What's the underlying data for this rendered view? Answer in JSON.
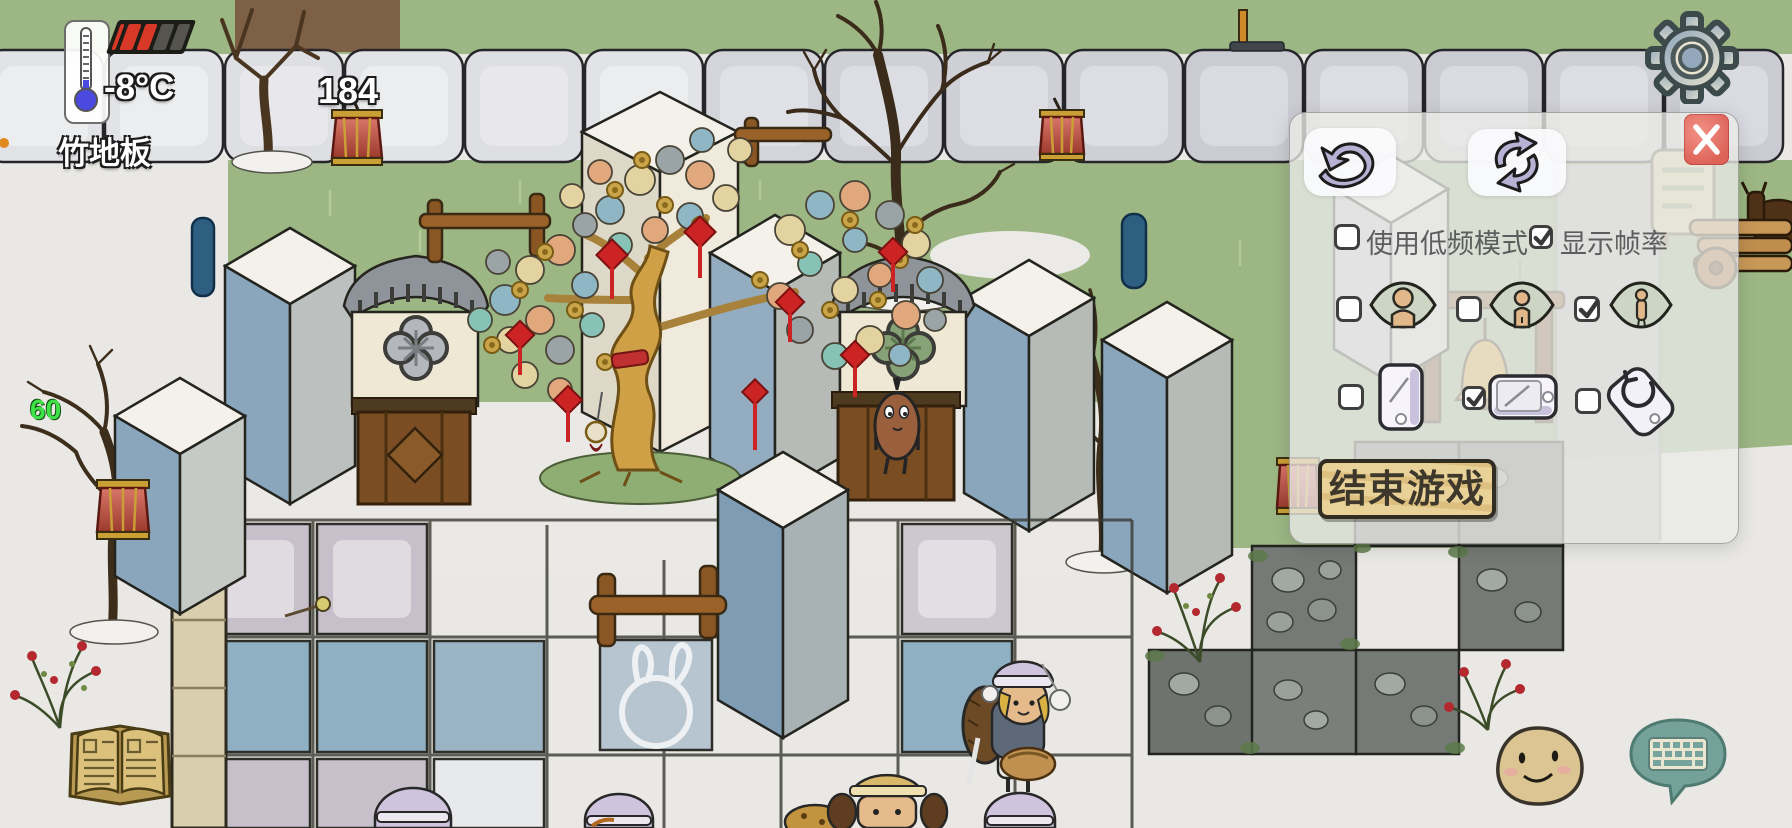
{
  "hud": {
    "temperature": "-8°C",
    "standing_on_label": "竹地板",
    "counter": "184",
    "fps": "60",
    "health": {
      "segments": [
        "partial",
        "full",
        "full",
        "empty",
        "empty"
      ]
    }
  },
  "panel": {
    "options": {
      "low_freq_mode": {
        "label": "使用低频模式",
        "checked": false
      },
      "show_fps": {
        "label": "显示帧率",
        "checked": true
      }
    },
    "view_distance": {
      "near": false,
      "mid": false,
      "far": true
    },
    "orientation": {
      "portrait": false,
      "landscape": true,
      "auto_rotate": false
    },
    "end_game_label": "结束游戏"
  },
  "icons": {
    "undo": "curved-undo-arrow",
    "restart": "cycle-arrows",
    "close": "white-x",
    "settings": "gear",
    "journal": "open-book",
    "emote": "smiley-face",
    "chat": "keyboard-speech-bubble",
    "view_toggles": "eye-with-figure",
    "orientation_toggles": "phone"
  },
  "colors": {
    "panel_bg": "rgba(235,235,232,0.78)",
    "close_red": "#dd6258",
    "wood_button": "#e3c98e",
    "fps_green": "#3fe347",
    "lantern_red": "#c0453a",
    "grass": "#9cb784",
    "snow": "#e9e8e4",
    "tile_blue": "#8fafc2"
  }
}
